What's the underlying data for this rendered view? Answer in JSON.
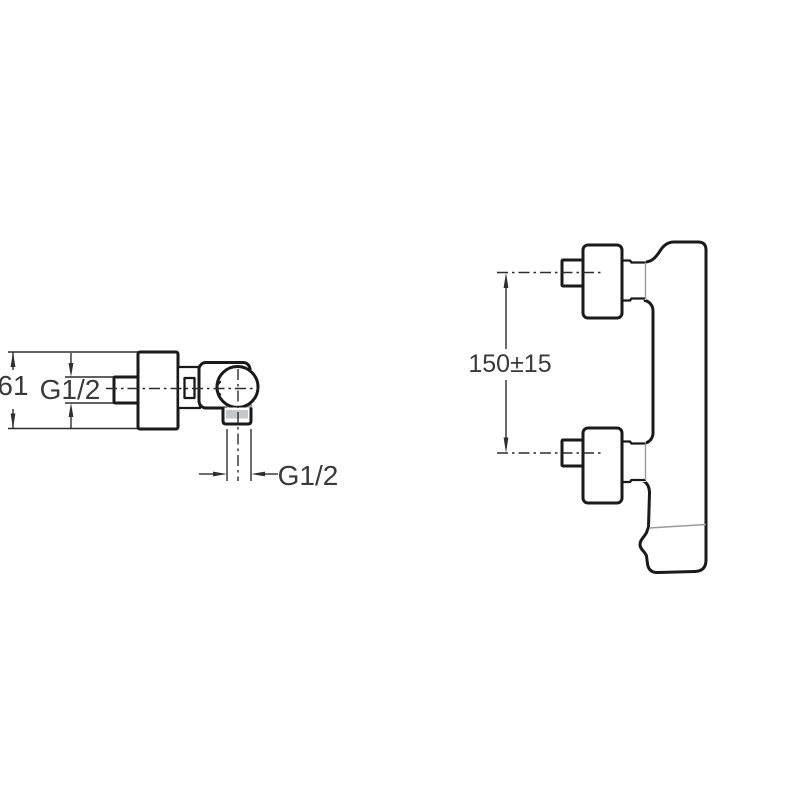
{
  "drawing": {
    "title": "faucet-technical-drawing",
    "background_color": "#ffffff",
    "line_color": "#1a1a1a",
    "dimension_line_color": "#2e2e2e",
    "text_color": "#3a3a3a",
    "side_view": {
      "height_dim": "61",
      "inlet_thread_dim": "G1/2",
      "outlet_thread_dim": "G1/2"
    },
    "front_view": {
      "inlet_spacing_dim": "150±15"
    }
  }
}
